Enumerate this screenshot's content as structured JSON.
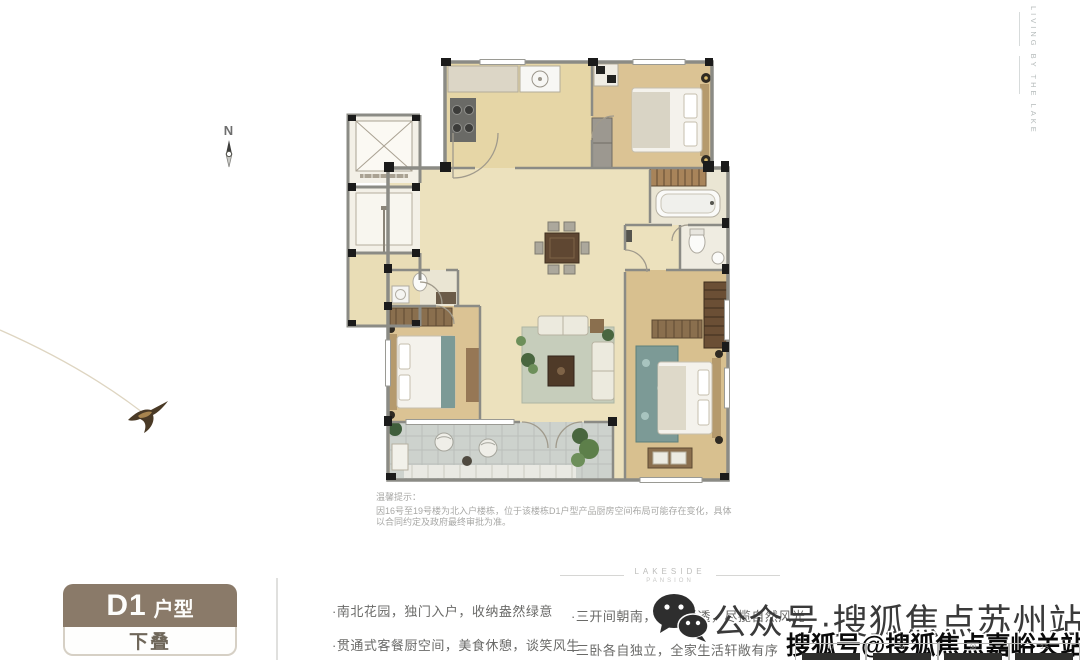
{
  "compass": {
    "label": "N"
  },
  "branding": {
    "vertical_text": "LIVING BY THE LAKE",
    "divider_line1": "LAKESIDE",
    "divider_line2": "PANSION"
  },
  "badge": {
    "main": "D1",
    "suffix": "户型",
    "sub": "下叠"
  },
  "notice": {
    "title": "温馨提示：",
    "body": "因16号至19号楼为北入户楼栋，位于该楼栋D1户型产品厨房空间布局可能存在变化，具体以合同约定及政府最终审批为准。"
  },
  "features": {
    "left": [
      "·南北花园，独门入户，收纳盎然绿意",
      "·贯通式客餐厨空间，美食休憩，谈笑风生"
    ],
    "right": [
      "·三开间朝南，全明通透，尽揽自然风光",
      "·三卧各自独立，全家生活轩敞有序"
    ]
  },
  "watermarks": {
    "wechat_text": "公众号·搜狐焦点苏州站",
    "sohu_text": "搜狐号@搜狐焦点嘉峪关站"
  },
  "mini_table": {
    "cells": [
      "37",
      "36",
      "38",
      "3.5"
    ]
  },
  "colors": {
    "badge_brown": "#8a7a69",
    "floor_beige": "#ece1bd",
    "floor_wood": "#dbc394",
    "patio_gray": "#cdd2cd",
    "wall_gray": "#8b8b85",
    "pier_black": "#1b1b1b",
    "rug_teal": "#7c9a96",
    "watermark_dark": "#3a3a3a"
  }
}
